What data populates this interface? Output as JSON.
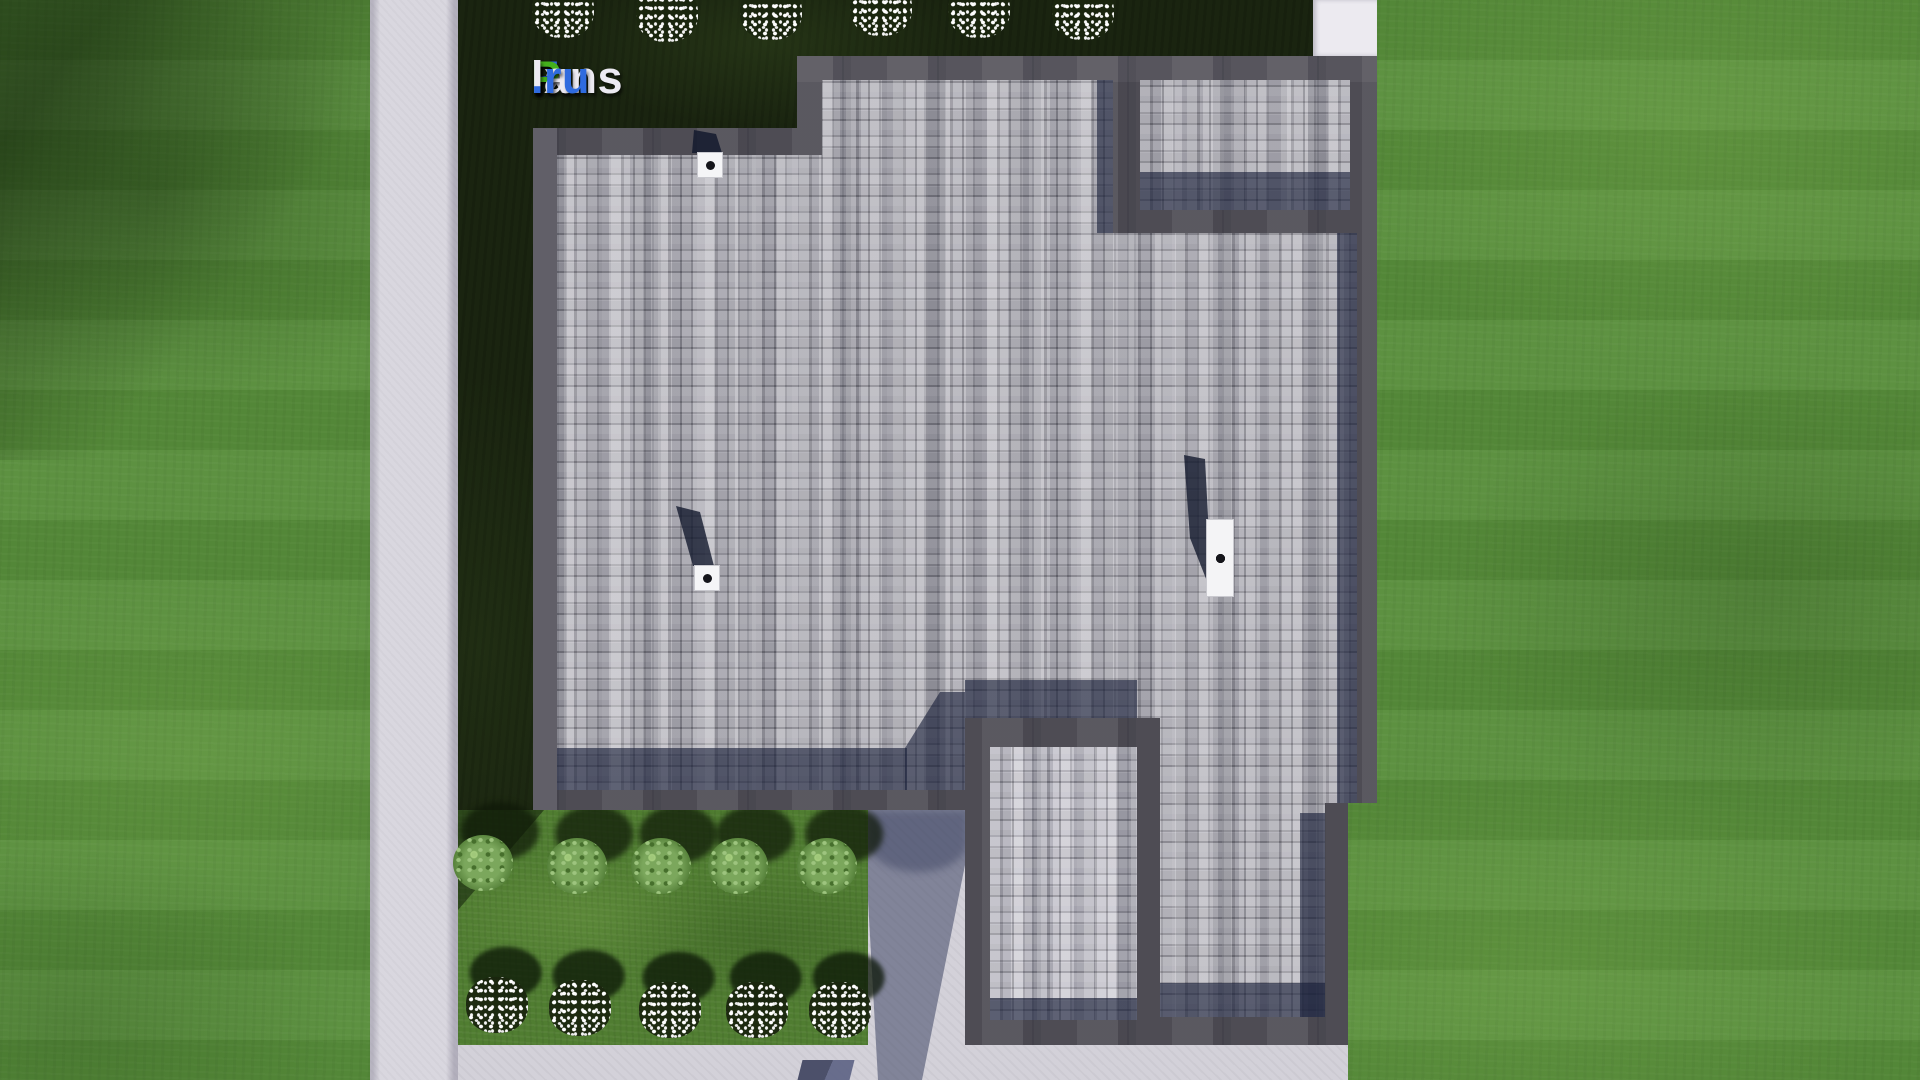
{
  "logo": {
    "text": "FixPlans.ru",
    "segments": [
      {
        "text": "F",
        "color": "#2f6bdf"
      },
      {
        "text": "ix",
        "color": "#eceaf2"
      },
      {
        "text": "P",
        "color": "#44b01c"
      },
      {
        "text": "lans",
        "color": "#eceaf2"
      },
      {
        "text": ".ru",
        "color": "#2f6bdf"
      }
    ]
  },
  "scene": {
    "description": "Top-down 3D render of a house roof plan surrounded by lawn, a sidewalk, dark planting beds, shrubs and white flower clusters",
    "colors": {
      "grass": "#578d3a",
      "sidewalk": "#d9d7df",
      "planting_bed": "#1a2410",
      "garden_bed": "#507d31",
      "roof_fascia": "#4e4c54",
      "roof_shingles": "#a3a2aa",
      "roof_shadow": "#39405a",
      "driveway": "#d3d1d9",
      "concrete_pad": "#eceaf0",
      "vent_white": "#f5f5f7"
    },
    "roof": {
      "vents": [
        {
          "id": "1",
          "x": 697,
          "y": 152,
          "size": 26
        },
        {
          "id": "2",
          "x": 694,
          "y": 565,
          "size": 26
        }
      ],
      "chimney": {
        "x": 1206,
        "y": 519,
        "width": 28,
        "height": 78,
        "dots": 4
      }
    },
    "bushes": {
      "count": 5,
      "positions": [
        [
          483,
          863
        ],
        [
          577,
          866
        ],
        [
          661,
          866
        ],
        [
          738,
          866
        ],
        [
          827,
          866
        ]
      ]
    },
    "flowers_top": {
      "count": 6,
      "positions": [
        [
          563,
          10
        ],
        [
          667,
          14
        ],
        [
          771,
          12
        ],
        [
          881,
          8
        ],
        [
          979,
          10
        ],
        [
          1083,
          12
        ]
      ]
    },
    "flowers_bottom": {
      "count": 5,
      "positions": [
        [
          497,
          1005
        ],
        [
          580,
          1008
        ],
        [
          670,
          1010
        ],
        [
          757,
          1010
        ],
        [
          840,
          1010
        ]
      ]
    }
  }
}
